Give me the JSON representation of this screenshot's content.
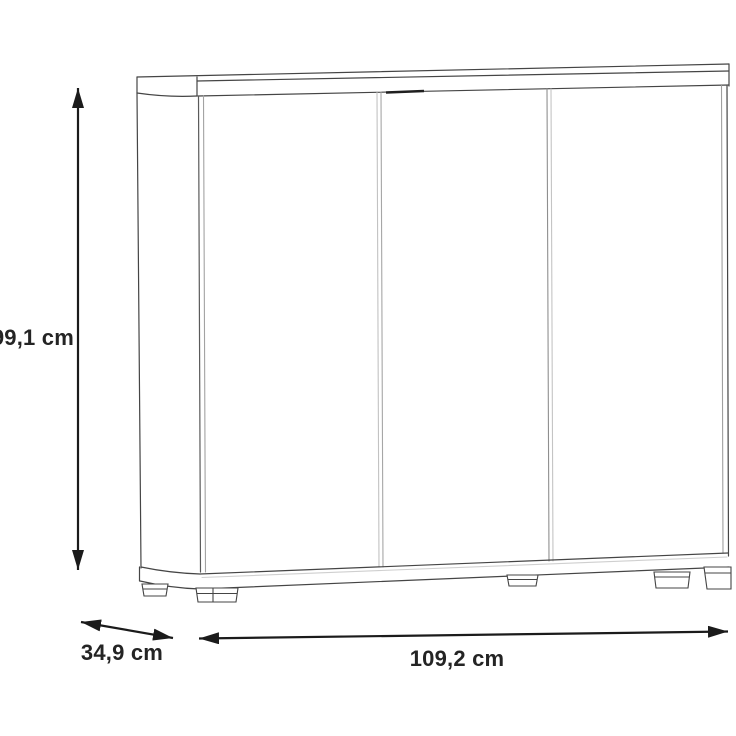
{
  "diagram": {
    "dimensions": {
      "height_label": "99,1 cm",
      "depth_label": "34,9 cm",
      "width_label": "109,2 cm"
    },
    "colors": {
      "outline": "#454545",
      "outline_mid": "#8f8f8f",
      "outline_light": "#c2c2c2",
      "arrow": "#1b1b1b",
      "label_text": "#242424",
      "fill": "#ffffff",
      "background": "#ffffff"
    }
  }
}
